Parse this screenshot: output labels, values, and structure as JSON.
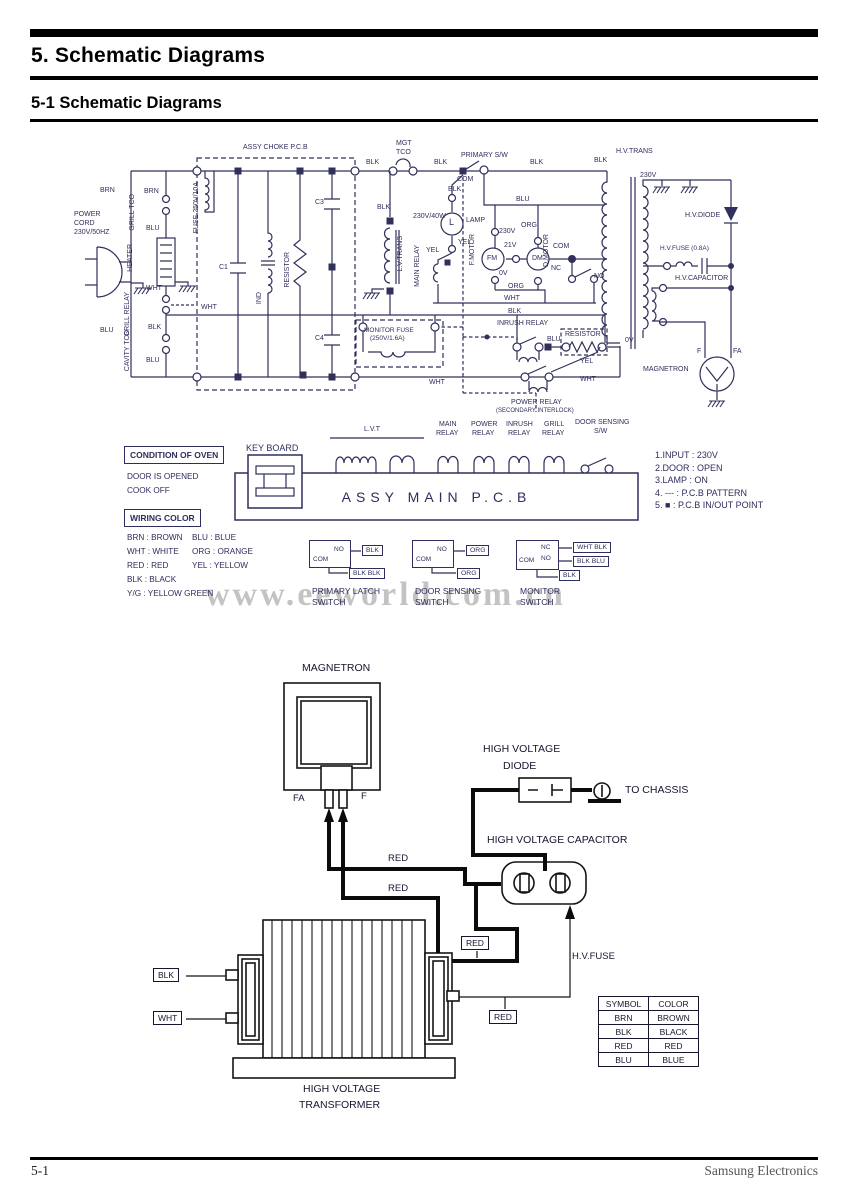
{
  "header": {
    "title": "5. Schematic Diagrams",
    "subtitle": "5-1 Schematic Diagrams"
  },
  "footer": {
    "page_number": "5-1",
    "company": "Samsung Electronics"
  },
  "watermark": "www.eeworld.com.cn",
  "condition_of_oven": {
    "title": "CONDITION OF OVEN",
    "lines": [
      "DOOR IS OPENED",
      "COOK OFF"
    ]
  },
  "wiring_color": {
    "title": "WIRING COLOR",
    "col1": [
      "BRN : BROWN",
      "WHT : WHITE",
      "RED : RED",
      "BLK : BLACK",
      "Y/G : YELLOW GREEN"
    ],
    "col2": [
      "BLU : BLUE",
      "ORG : ORANGE",
      "YEL : YELLOW"
    ]
  },
  "keyboard_label": "KEY BOARD",
  "main_pcb_label": "ASSY MAIN P.C.B",
  "notes": [
    "1.INPUT : 230V",
    "2.DOOR : OPEN",
    "3.LAMP : ON",
    "4. --- : P.C.B PATTERN",
    "5.  ■  : P.C.B IN/OUT POINT"
  ],
  "switches": [
    {
      "caption1": "PRIMARY LATCH",
      "caption2": "SWITCH",
      "term_com": "COM",
      "term_no": "NO",
      "tag_right": "BLK",
      "tag_bottom": "BLK  BLK"
    },
    {
      "caption1": "DOOR SENSING",
      "caption2": "SWITCH",
      "term_com": "COM",
      "term_no": "NO",
      "tag_right": "ORG",
      "tag_bottom": "ORG"
    },
    {
      "caption1": "MONITOR",
      "caption2": "SWITCH",
      "term_com": "COM",
      "term_nc": "NC",
      "term_no": "NO",
      "tag_nc": "WHT  BLK",
      "tag_no": "BLK  BLU",
      "tag_bottom": "BLK"
    }
  ],
  "schematic_labels": [
    {
      "t": "ASSY CHOKE P.C.B",
      "x": 243,
      "y": 144
    },
    {
      "t": "MGT",
      "x": 396,
      "y": 140
    },
    {
      "t": "TCO",
      "x": 396,
      "y": 149
    },
    {
      "t": "PRIMARY S/W",
      "x": 461,
      "y": 152
    },
    {
      "t": "H.V.TRANS",
      "x": 616,
      "y": 148
    },
    {
      "t": "BLK",
      "x": 366,
      "y": 159
    },
    {
      "t": "BLK",
      "x": 434,
      "y": 159
    },
    {
      "t": "BLK",
      "x": 530,
      "y": 159
    },
    {
      "t": "BLK",
      "x": 594,
      "y": 157
    },
    {
      "t": "230V",
      "x": 640,
      "y": 172
    },
    {
      "t": "BRN",
      "x": 100,
      "y": 187
    },
    {
      "t": "BRN",
      "x": 144,
      "y": 188
    },
    {
      "t": "POWER",
      "x": 74,
      "y": 211
    },
    {
      "t": "CORD",
      "x": 74,
      "y": 220
    },
    {
      "t": "230V/50HZ",
      "x": 74,
      "y": 229
    },
    {
      "t": "GRILL TCO",
      "x": 129,
      "y": 194,
      "v": 1
    },
    {
      "t": "BLU",
      "x": 146,
      "y": 225
    },
    {
      "t": "HEATER",
      "x": 127,
      "y": 244,
      "v": 1
    },
    {
      "t": "WHT",
      "x": 146,
      "y": 285
    },
    {
      "t": "GRILL RELAY",
      "x": 124,
      "y": 292,
      "v": 1
    },
    {
      "t": "BLK",
      "x": 148,
      "y": 324
    },
    {
      "t": "CAVITY TCO",
      "x": 124,
      "y": 330,
      "v": 1
    },
    {
      "t": "BLU",
      "x": 146,
      "y": 357
    },
    {
      "t": "BLU",
      "x": 100,
      "y": 327
    },
    {
      "t": "FUSE 250V/10A",
      "x": 193,
      "y": 182,
      "v": 1
    },
    {
      "t": "C1",
      "x": 219,
      "y": 264
    },
    {
      "t": "IND",
      "x": 256,
      "y": 292,
      "v": 1
    },
    {
      "t": "RESISTOR",
      "x": 284,
      "y": 252,
      "v": 1
    },
    {
      "t": "C3",
      "x": 315,
      "y": 199
    },
    {
      "t": "C4",
      "x": 315,
      "y": 335
    },
    {
      "t": "WHT",
      "x": 201,
      "y": 304
    },
    {
      "t": "WHT",
      "x": 429,
      "y": 379
    },
    {
      "t": "BLK",
      "x": 377,
      "y": 204
    },
    {
      "t": "L.V.TRANS",
      "x": 397,
      "y": 236,
      "v": 1
    },
    {
      "t": "MAIN RELAY",
      "x": 414,
      "y": 245,
      "v": 1
    },
    {
      "t": "230V/40W",
      "x": 413,
      "y": 213
    },
    {
      "t": "L",
      "x": 449,
      "y": 218,
      "s": 9
    },
    {
      "t": "LAMP",
      "x": 466,
      "y": 217
    },
    {
      "t": "YEL",
      "x": 458,
      "y": 239
    },
    {
      "t": "YEL",
      "x": 426,
      "y": 247
    },
    {
      "t": "COM",
      "x": 457,
      "y": 176
    },
    {
      "t": "BLK",
      "x": 448,
      "y": 186
    },
    {
      "t": "BLU",
      "x": 516,
      "y": 196
    },
    {
      "t": "ORG",
      "x": 521,
      "y": 222
    },
    {
      "t": "230V",
      "x": 499,
      "y": 228
    },
    {
      "t": "21V",
      "x": 504,
      "y": 242
    },
    {
      "t": "0V",
      "x": 499,
      "y": 270
    },
    {
      "t": "F.MOTOR",
      "x": 469,
      "y": 234,
      "v": 1
    },
    {
      "t": "FM",
      "x": 487,
      "y": 255
    },
    {
      "t": "D.MOTOR",
      "x": 543,
      "y": 234,
      "v": 1
    },
    {
      "t": "DM",
      "x": 532,
      "y": 255
    },
    {
      "t": "COM",
      "x": 553,
      "y": 243
    },
    {
      "t": "NC",
      "x": 551,
      "y": 265
    },
    {
      "t": "NO",
      "x": 594,
      "y": 273
    },
    {
      "t": "ORG",
      "x": 508,
      "y": 283
    },
    {
      "t": "WHT",
      "x": 504,
      "y": 295
    },
    {
      "t": "BLK",
      "x": 508,
      "y": 308
    },
    {
      "t": "MONITOR FUSE",
      "x": 364,
      "y": 328,
      "s": 6.5
    },
    {
      "t": "(250V/1.6A)",
      "x": 370,
      "y": 336,
      "s": 6.5
    },
    {
      "t": "INRUSH RELAY",
      "x": 497,
      "y": 320
    },
    {
      "t": "RESISTOR",
      "x": 565,
      "y": 331
    },
    {
      "t": "BLU",
      "x": 547,
      "y": 336
    },
    {
      "t": "YEL",
      "x": 580,
      "y": 358
    },
    {
      "t": "WHT",
      "x": 580,
      "y": 376
    },
    {
      "t": "0V",
      "x": 625,
      "y": 337
    },
    {
      "t": "POWER RELAY",
      "x": 511,
      "y": 399
    },
    {
      "t": "(SECONDARY INTERLOCK)",
      "x": 496,
      "y": 408,
      "s": 6
    },
    {
      "t": "H.V.DIODE",
      "x": 685,
      "y": 212
    },
    {
      "t": "H.V.FUSE (0.8A)",
      "x": 660,
      "y": 246,
      "s": 6.5
    },
    {
      "t": "H.V.CAPACITOR",
      "x": 675,
      "y": 275
    },
    {
      "t": "MAGNETRON",
      "x": 643,
      "y": 366
    },
    {
      "t": "F",
      "x": 697,
      "y": 348
    },
    {
      "t": "FA",
      "x": 733,
      "y": 348
    },
    {
      "t": "L.V.T",
      "x": 364,
      "y": 426
    },
    {
      "t": "MAIN",
      "x": 439,
      "y": 421
    },
    {
      "t": "RELAY",
      "x": 436,
      "y": 430
    },
    {
      "t": "POWER",
      "x": 471,
      "y": 421
    },
    {
      "t": "RELAY",
      "x": 472,
      "y": 430
    },
    {
      "t": "INRUSH",
      "x": 506,
      "y": 421
    },
    {
      "t": "RELAY",
      "x": 508,
      "y": 430
    },
    {
      "t": "GRILL",
      "x": 544,
      "y": 421
    },
    {
      "t": "RELAY",
      "x": 542,
      "y": 430
    },
    {
      "t": "DOOR SENSING",
      "x": 575,
      "y": 419
    },
    {
      "t": "S/W",
      "x": 594,
      "y": 428
    }
  ],
  "bottom": {
    "magnetron": "MAGNETRON",
    "fa": "FA",
    "f": "F",
    "hv_diode_l1": "HIGH VOLTAGE",
    "hv_diode_l2": "DIODE",
    "to_chassis": "TO CHASSIS",
    "hv_capacitor": "HIGH VOLTAGE CAPACITOR",
    "hv_fuse": "H.V.FUSE",
    "red_a": "RED",
    "red_b": "RED",
    "red_tag1": "RED",
    "red_tag2": "RED",
    "blk_tag": "BLK",
    "wht_tag": "WHT",
    "transformer_l1": "HIGH VOLTAGE",
    "transformer_l2": "TRANSFORMER",
    "color_table": {
      "headers": [
        "SYMBOL",
        "COLOR"
      ],
      "rows": [
        [
          "BRN",
          "BROWN"
        ],
        [
          "BLK",
          "BLACK"
        ],
        [
          "RED",
          "RED"
        ],
        [
          "BLU",
          "BLUE"
        ]
      ]
    }
  }
}
